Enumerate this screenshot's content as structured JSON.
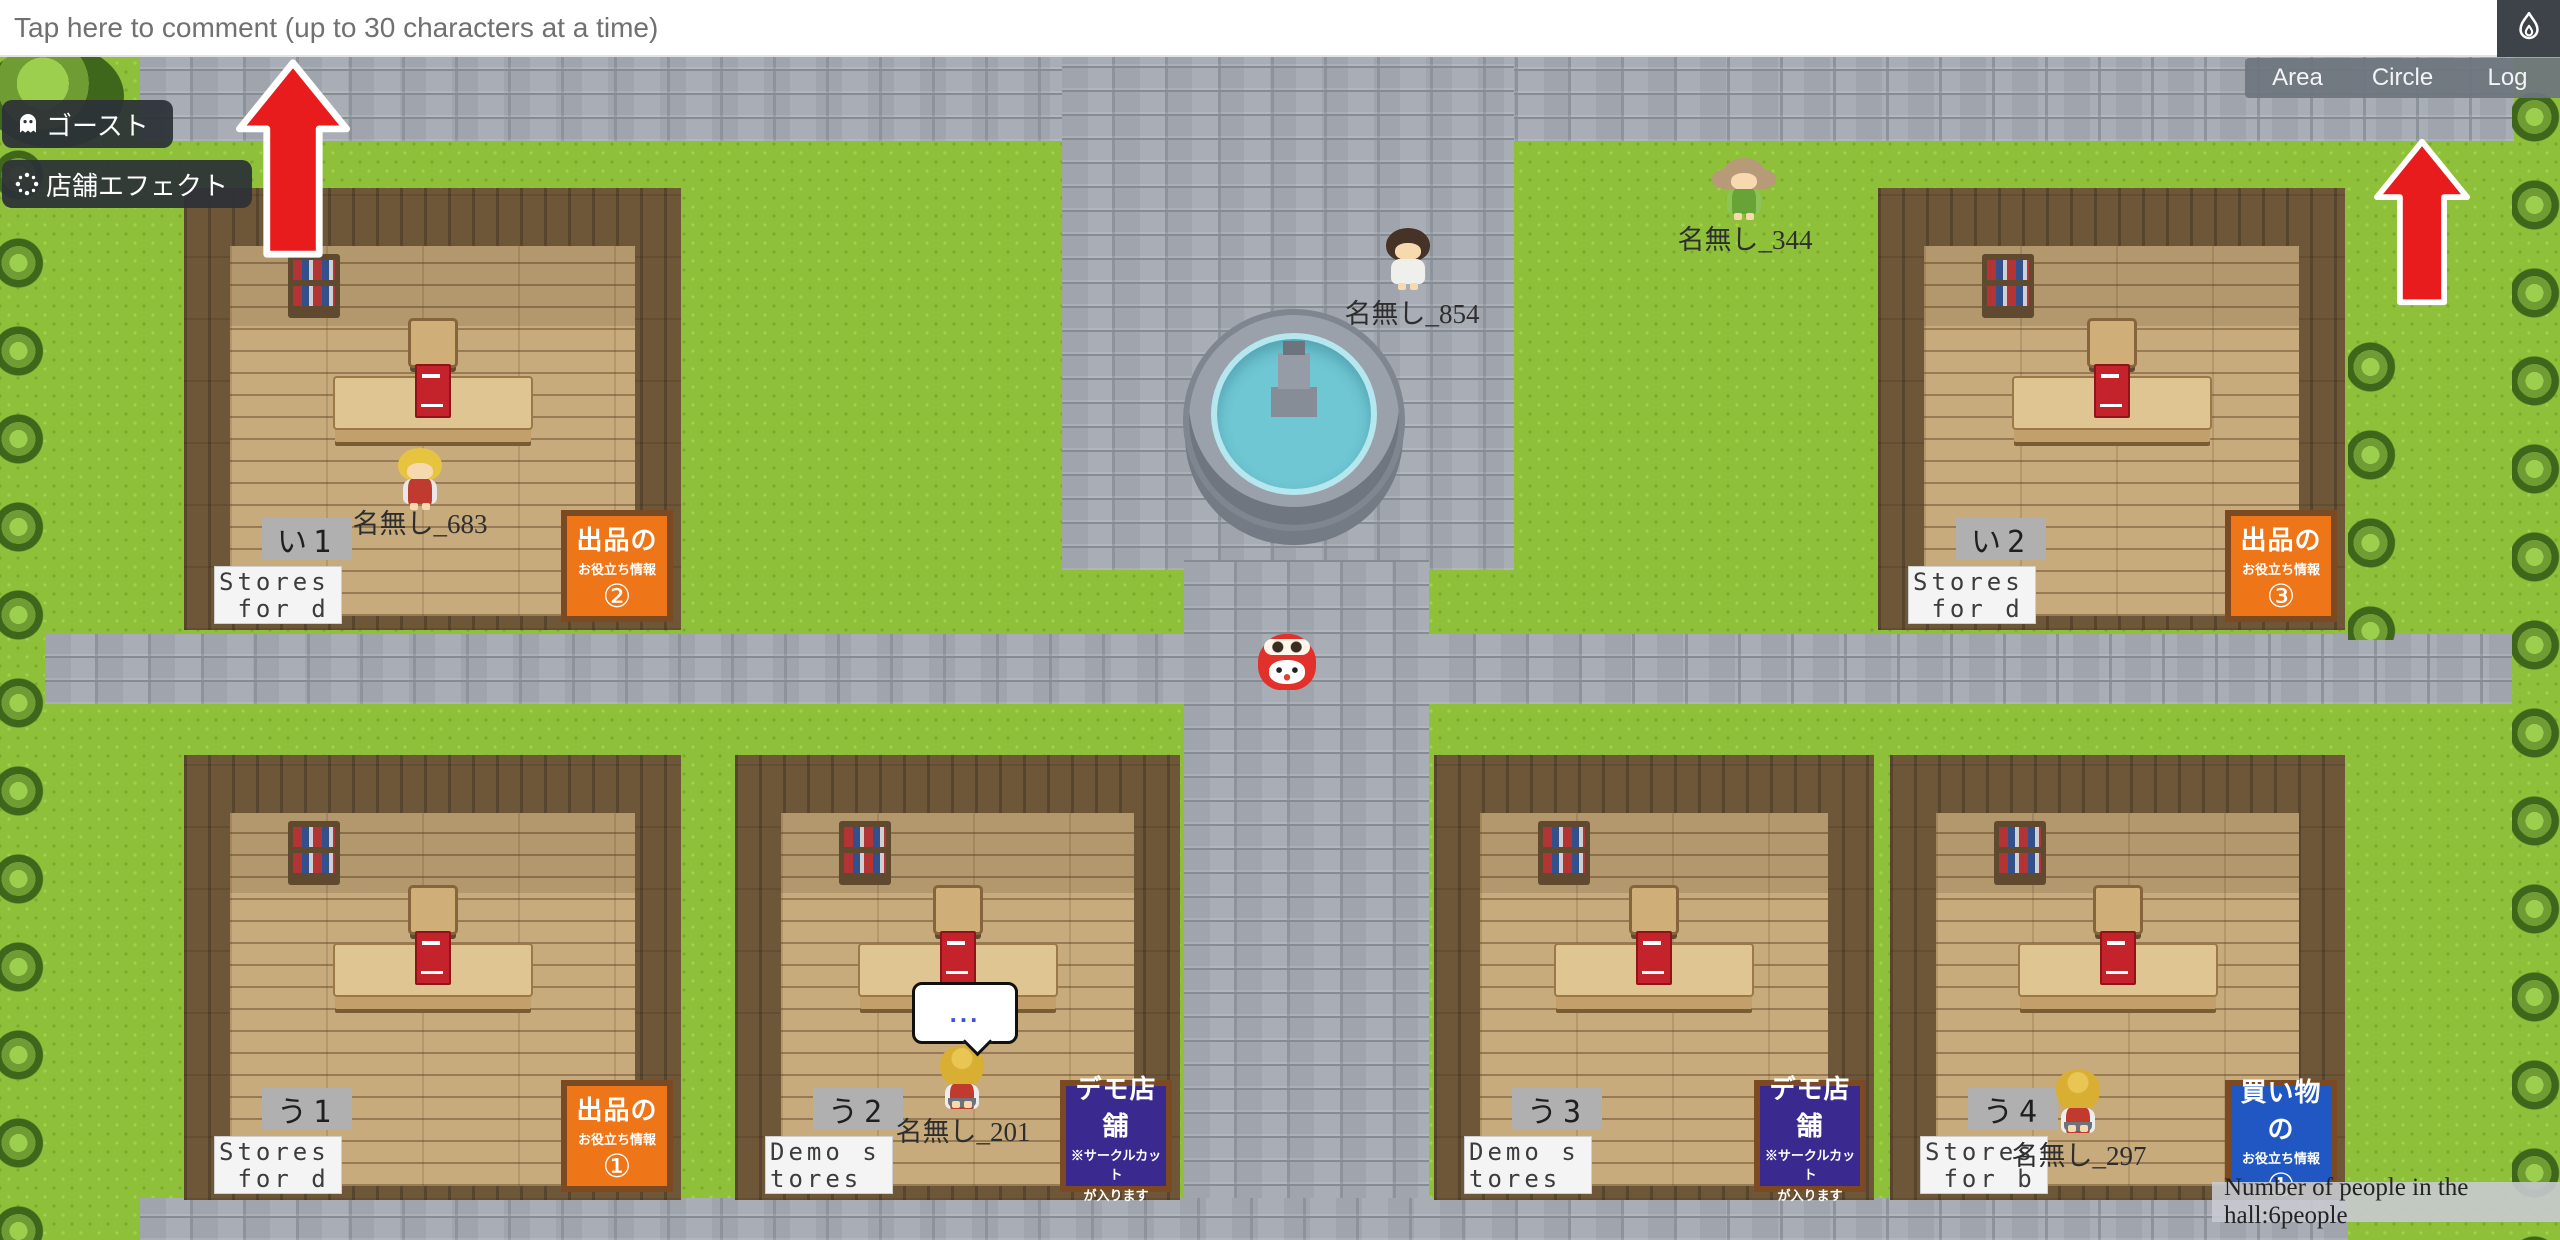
{
  "comment_bar": {
    "placeholder": "Tap here to comment (up to 30 characters at a time)"
  },
  "top_right": {
    "corner_icon": "flame-icon",
    "tabs": [
      "Area",
      "Circle",
      "Log"
    ]
  },
  "left_buttons": [
    {
      "icon": "ghost-icon",
      "label": "ゴースト"
    },
    {
      "icon": "sparkle-dots-icon",
      "label": "店舗エフェクト"
    }
  ],
  "status": {
    "text": "Number of people in the hall:6people"
  },
  "players": [
    {
      "name": "名無し_683"
    },
    {
      "name": "名無し_854"
    },
    {
      "name": "名無し_344"
    },
    {
      "name": "名無し_201",
      "bubble": "..."
    },
    {
      "name": "名無し_297"
    }
  ],
  "npc": {
    "name": "red-mascot"
  },
  "buildings": [
    {
      "plate": "い1",
      "store_sign": "Stores\n for d",
      "info_title": "出品の",
      "info_subtitle": "お役立ち情報",
      "info_number": "②"
    },
    {
      "plate": "い2",
      "store_sign": "Stores\n for d",
      "info_title": "出品の",
      "info_subtitle": "お役立ち情報",
      "info_number": "③"
    },
    {
      "plate": "う1",
      "store_sign": "Stores\n for d",
      "info_title": "出品の",
      "info_subtitle": "お役立ち情報",
      "info_number": "①"
    },
    {
      "plate": "う2",
      "store_sign": "Demo s\ntores",
      "info_title": "デモ店舗",
      "info_subtitle": "※サークルカット",
      "info_subtitle2": "が入ります"
    },
    {
      "plate": "う3",
      "store_sign": "Demo s\ntores",
      "info_title": "デモ店舗",
      "info_subtitle": "※サークルカット",
      "info_subtitle2": "が入ります"
    },
    {
      "plate": "う4",
      "store_sign": "Stores\n for b",
      "info_title": "買い物の",
      "info_subtitle": "お役立ち情報",
      "info_number": "①"
    }
  ],
  "colors": {
    "arrow_red": "#e81c1c",
    "sign_orange": "#ee7518",
    "sign_purple": "#3a2a90",
    "sign_blue": "#2057c2",
    "grass": "#8fc03a",
    "stone": "#a9aeb6"
  }
}
